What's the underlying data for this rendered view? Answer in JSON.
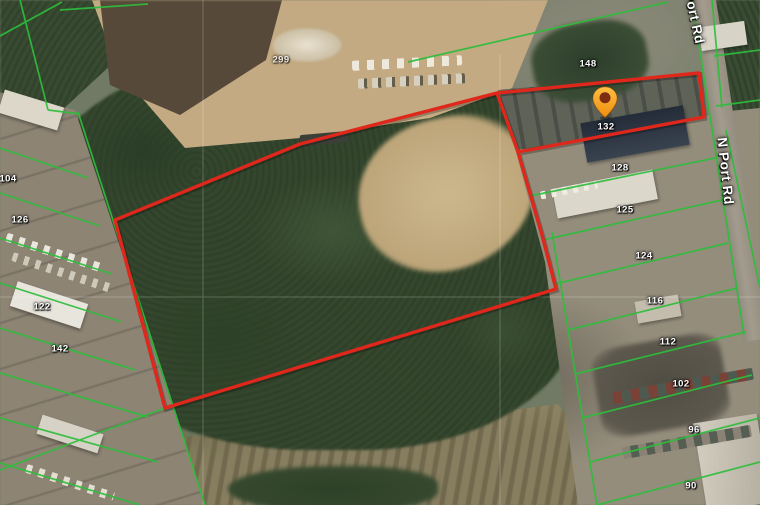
{
  "map": {
    "description": "Satellite parcel map with subject property outlined in red",
    "road_name": "N Port Rd",
    "pin": {
      "label": "132"
    },
    "road_labels": [
      {
        "text": "N Port Rd",
        "x": 686,
        "y": -30,
        "rotation": 78
      },
      {
        "text": "N Port Rd",
        "x": 722,
        "y": 130,
        "rotation": 84
      }
    ],
    "parcel_labels": [
      {
        "text": "104",
        "x": 8,
        "y": 179
      },
      {
        "text": "126",
        "x": 20,
        "y": 220
      },
      {
        "text": "122",
        "x": 42,
        "y": 307
      },
      {
        "text": "142",
        "x": 60,
        "y": 349
      },
      {
        "text": "299",
        "x": 281,
        "y": 60,
        "muted": true
      },
      {
        "text": "148",
        "x": 588,
        "y": 64
      },
      {
        "text": "128",
        "x": 620,
        "y": 168
      },
      {
        "text": "125",
        "x": 625,
        "y": 210
      },
      {
        "text": "124",
        "x": 644,
        "y": 256
      },
      {
        "text": "116",
        "x": 655,
        "y": 301
      },
      {
        "text": "112",
        "x": 668,
        "y": 342
      },
      {
        "text": "102",
        "x": 681,
        "y": 384
      },
      {
        "text": "96",
        "x": 694,
        "y": 430
      },
      {
        "text": "90",
        "x": 691,
        "y": 486
      }
    ],
    "colors": {
      "parcel_line": "#2ebd3c",
      "subject_boundary": "#e0271b",
      "pin_body": "#f9a01b",
      "pin_core": "#7c2d12",
      "road_label": "#ffffff",
      "parcel_label": "#ffffff"
    }
  }
}
